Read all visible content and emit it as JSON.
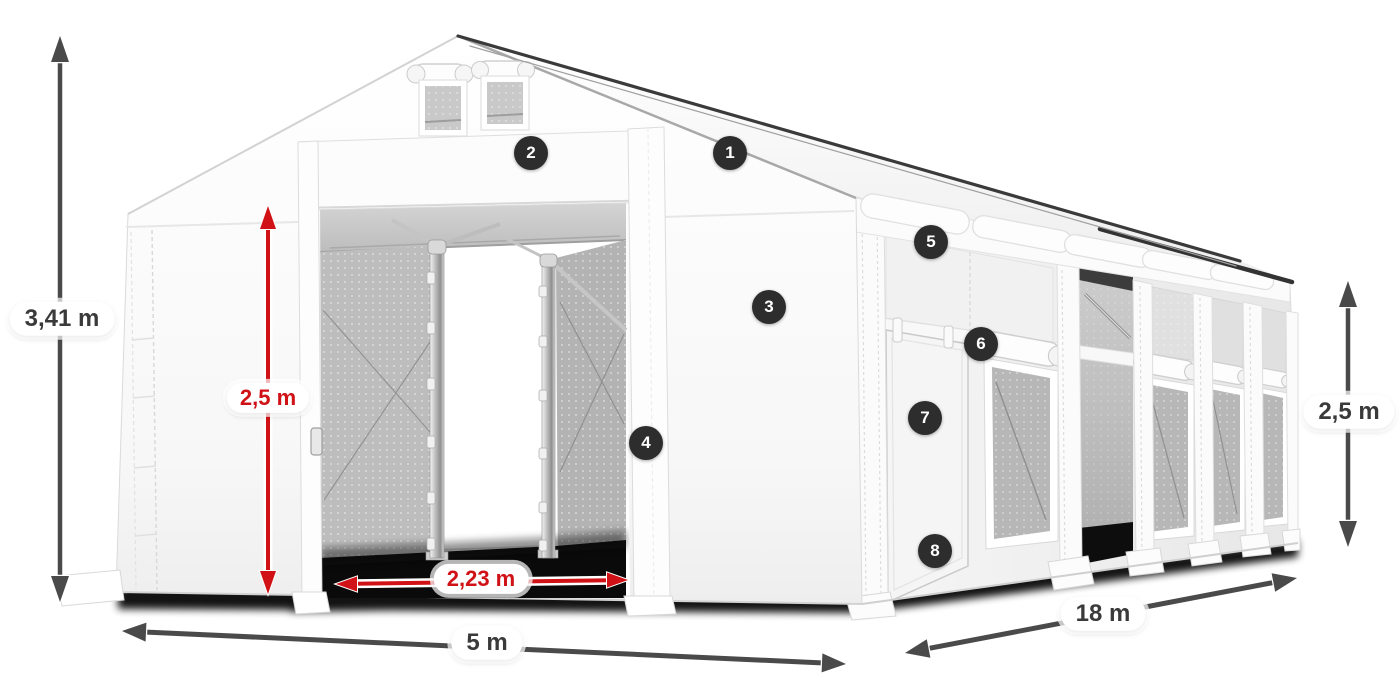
{
  "diagram": {
    "dimensions": {
      "total_height": "3,41 m",
      "entrance_height": "2,5 m",
      "entrance_width": "2,23 m",
      "front_width": "5 m",
      "side_length": "18 m",
      "side_wall_height": "2,5 m"
    },
    "callouts": [
      "1",
      "2",
      "3",
      "4",
      "5",
      "6",
      "7",
      "8"
    ],
    "colors": {
      "dimension_red": "#d01216",
      "dimension_gray": "#4a4a4a",
      "badge_background": "#2d2d2d",
      "label_text": "#3a3a3a",
      "pill_background": "#ffffff"
    }
  }
}
